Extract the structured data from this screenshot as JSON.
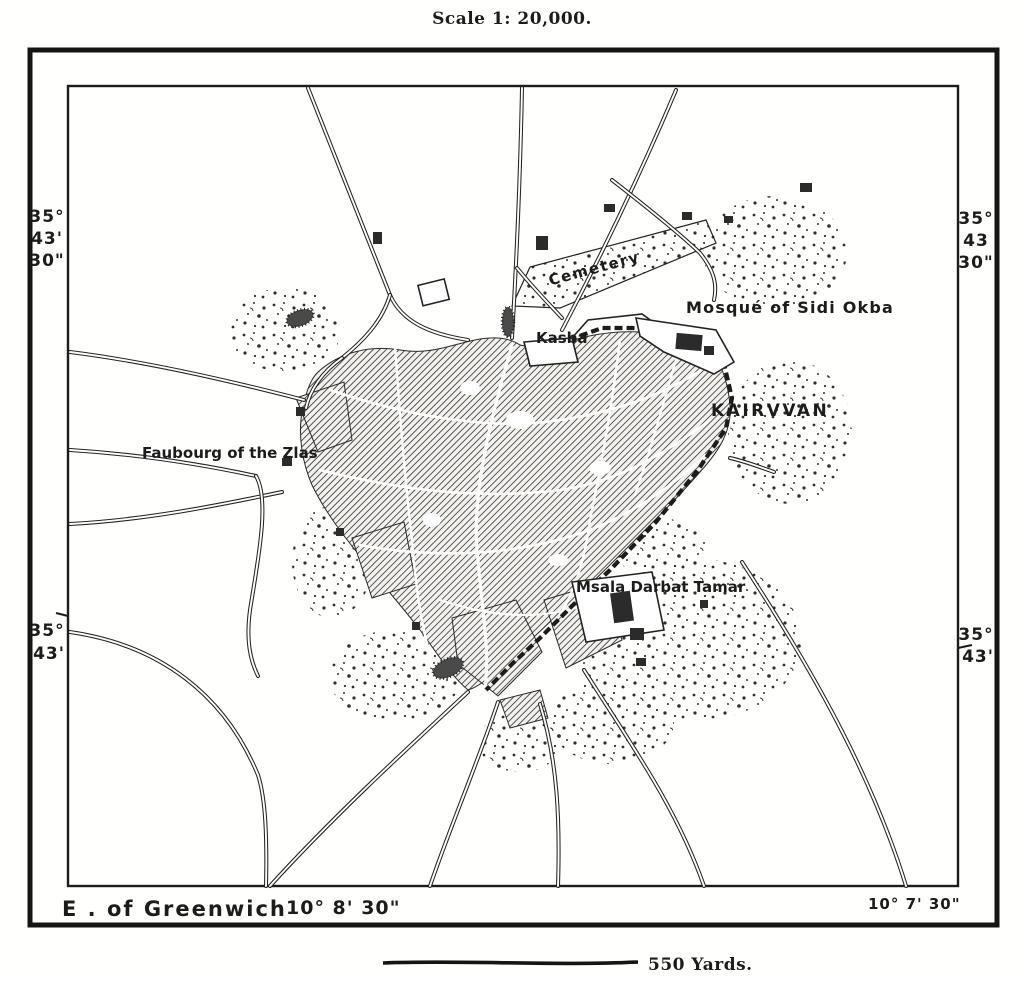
{
  "title": "Scale 1: 20,000.",
  "frame": {
    "coords": {
      "top_left": {
        "deg": "35°",
        "min": "43'",
        "sec": "30\""
      },
      "top_right": {
        "deg": "35°",
        "min": "43",
        "sec": "30\""
      },
      "bottom_left": {
        "deg": "35°",
        "min": "43'"
      },
      "bottom_right": {
        "deg": "35°",
        "min": "43'"
      }
    },
    "greenwich_label": "E . of Greenwich",
    "longitude_left": "10° 8' 30\"",
    "longitude_right": "10° 7' 30\""
  },
  "map_labels": {
    "cemetery": "Cemetery",
    "mosque": "Mosqué of Sidi Okba",
    "kasba": "Kasba",
    "city_name": "KAIRVVAN",
    "faubourg": "Faubourg of the Zlas",
    "msala": "Msala Darbat Tamar"
  },
  "scale_bar": {
    "label": "550 Yards."
  },
  "colors": {
    "ink": "#1c1c1c",
    "paper": "#ffffff"
  }
}
